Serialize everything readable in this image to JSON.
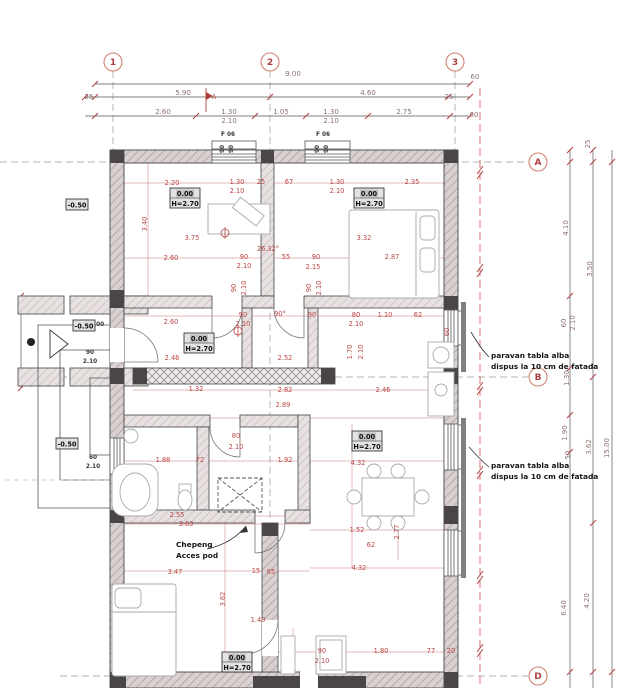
{
  "drawing": {
    "colors": {
      "dim_red": "#b84444",
      "chain_gray": "#8f7070",
      "axis_red": "#cc5555",
      "axis_gray": "#9a9a9a",
      "wall_fill": "#d8d0d0",
      "column_dark": "#4a4549",
      "bubble": "#d08070",
      "ink": "#444444"
    },
    "grid": {
      "col_bubble_y": 62,
      "row_bubble_x": 538,
      "cols": [
        {
          "label": "1",
          "x": 113
        },
        {
          "label": "2",
          "x": 270
        },
        {
          "label": "3",
          "x": 455
        }
      ],
      "rows": [
        {
          "label": "A",
          "y": 162
        },
        {
          "label": "B",
          "y": 377
        },
        {
          "label": "D",
          "y": 676
        }
      ]
    },
    "level_boxes": [
      {
        "l1": "0.00",
        "l2": "H=2.70",
        "x": 170,
        "y": 188
      },
      {
        "l1": "0.00",
        "l2": "H=2.70",
        "x": 354,
        "y": 188
      },
      {
        "l1": "0.00",
        "l2": "H=2.70",
        "x": 184,
        "y": 333
      },
      {
        "l1": "0.00",
        "l2": "H=2.70",
        "x": 352,
        "y": 431
      },
      {
        "l1": "0.00",
        "l2": "H=2.70",
        "x": 222,
        "y": 652
      }
    ],
    "elev_boxes": [
      {
        "t": "-0.50",
        "x": 66,
        "y": 199
      },
      {
        "t": "-0.50",
        "x": 73,
        "y": 320
      },
      {
        "t": "-0.50",
        "x": 56,
        "y": 438
      }
    ],
    "notes": [
      {
        "lines": [
          "paravan tabla alba",
          "dispus la 10 cm de fatada"
        ],
        "x": 491,
        "y": 358
      },
      {
        "lines": [
          "paravan tabla alba",
          "dispus la 10 cm de fatada"
        ],
        "x": 491,
        "y": 468
      },
      {
        "lines": [
          "Chepeng",
          "Acces pod"
        ],
        "x": 176,
        "y": 547
      }
    ],
    "labels": [
      {
        "t": "9.00",
        "x": 293,
        "y": 76,
        "c": "g"
      },
      {
        "t": "60",
        "x": 475,
        "y": 79,
        "c": "g"
      },
      {
        "t": "25",
        "x": 89,
        "y": 99,
        "c": "g"
      },
      {
        "t": "5.90",
        "x": 183,
        "y": 95,
        "c": "g"
      },
      {
        "t": "4.60",
        "x": 368,
        "y": 95,
        "c": "g"
      },
      {
        "t": "25",
        "x": 449,
        "y": 99,
        "c": "g"
      },
      {
        "t": "2.60",
        "x": 163,
        "y": 114,
        "c": "g"
      },
      {
        "t": "1.30",
        "x": 229,
        "y": 114,
        "c": "g"
      },
      {
        "t": "2.10",
        "x": 229,
        "y": 123,
        "c": "g"
      },
      {
        "t": "1.05",
        "x": 281,
        "y": 114,
        "c": "g"
      },
      {
        "t": "1.30",
        "x": 331,
        "y": 114,
        "c": "g"
      },
      {
        "t": "2.10",
        "x": 331,
        "y": 123,
        "c": "g"
      },
      {
        "t": "2.75",
        "x": 404,
        "y": 114,
        "c": "g"
      },
      {
        "t": "60",
        "x": 474,
        "y": 117,
        "c": "g"
      },
      {
        "t": "A",
        "x": 214,
        "y": 99
      },
      {
        "t": "F 06",
        "x": 228,
        "y": 136,
        "c": "t"
      },
      {
        "t": "F 06",
        "x": 323,
        "y": 136,
        "c": "t"
      },
      {
        "t": "90",
        "x": 224,
        "y": 149,
        "c": "t",
        "r": 1
      },
      {
        "t": "90",
        "x": 233,
        "y": 149,
        "c": "t",
        "r": 1
      },
      {
        "t": "90",
        "x": 319,
        "y": 149,
        "c": "t",
        "r": 1
      },
      {
        "t": "90",
        "x": 328,
        "y": 149,
        "c": "t",
        "r": 1
      },
      {
        "t": "2.20",
        "x": 172,
        "y": 185
      },
      {
        "t": "1.30",
        "x": 237,
        "y": 184
      },
      {
        "t": "2.10",
        "x": 237,
        "y": 193
      },
      {
        "t": "25",
        "x": 261,
        "y": 184
      },
      {
        "t": "67",
        "x": 289,
        "y": 184
      },
      {
        "t": "1.30",
        "x": 337,
        "y": 184
      },
      {
        "t": "2.10",
        "x": 337,
        "y": 193
      },
      {
        "t": "2.35",
        "x": 412,
        "y": 184
      },
      {
        "t": "3.40",
        "x": 147,
        "y": 224,
        "r": 1
      },
      {
        "t": "3.75",
        "x": 192,
        "y": 240
      },
      {
        "t": "3.32",
        "x": 364,
        "y": 240
      },
      {
        "t": "2.60",
        "x": 171,
        "y": 260
      },
      {
        "t": "90",
        "x": 244,
        "y": 259
      },
      {
        "t": "2.10",
        "x": 244,
        "y": 268
      },
      {
        "t": "55",
        "x": 286,
        "y": 259
      },
      {
        "t": "90",
        "x": 316,
        "y": 259
      },
      {
        "t": "2.87",
        "x": 392,
        "y": 259
      },
      {
        "t": "2.15",
        "x": 313,
        "y": 269
      },
      {
        "t": "26.32°",
        "x": 268,
        "y": 251
      },
      {
        "t": "90",
        "x": 236,
        "y": 288,
        "r": 1
      },
      {
        "t": "2.10",
        "x": 246,
        "y": 288,
        "r": 1
      },
      {
        "t": "90",
        "x": 311,
        "y": 288,
        "r": 1
      },
      {
        "t": "2.10",
        "x": 321,
        "y": 288,
        "r": 1
      },
      {
        "t": "2.60",
        "x": 171,
        "y": 324
      },
      {
        "t": "90",
        "x": 243,
        "y": 317
      },
      {
        "t": "2.10",
        "x": 243,
        "y": 326
      },
      {
        "t": "90°",
        "x": 280,
        "y": 316
      },
      {
        "t": "90",
        "x": 312,
        "y": 317
      },
      {
        "t": "80",
        "x": 356,
        "y": 317
      },
      {
        "t": "2.10",
        "x": 356,
        "y": 326
      },
      {
        "t": "1.10",
        "x": 385,
        "y": 317
      },
      {
        "t": "62",
        "x": 418,
        "y": 317
      },
      {
        "t": "2.46",
        "x": 172,
        "y": 360
      },
      {
        "t": "2.52",
        "x": 285,
        "y": 360
      },
      {
        "t": "1.70",
        "x": 352,
        "y": 352,
        "r": 1
      },
      {
        "t": "2.10",
        "x": 363,
        "y": 352,
        "r": 1
      },
      {
        "t": "1.32",
        "x": 196,
        "y": 391
      },
      {
        "t": "2.82",
        "x": 285,
        "y": 392
      },
      {
        "t": "2.46",
        "x": 383,
        "y": 392
      },
      {
        "t": "2.89",
        "x": 283,
        "y": 407
      },
      {
        "t": "80",
        "x": 236,
        "y": 438
      },
      {
        "t": "2.10",
        "x": 236,
        "y": 449
      },
      {
        "t": "1.88",
        "x": 163,
        "y": 462
      },
      {
        "t": "72",
        "x": 200,
        "y": 462
      },
      {
        "t": "1.92",
        "x": 285,
        "y": 462
      },
      {
        "t": "2.55",
        "x": 177,
        "y": 517
      },
      {
        "t": "3.63",
        "x": 186,
        "y": 526
      },
      {
        "t": "3.47",
        "x": 175,
        "y": 574
      },
      {
        "t": "15",
        "x": 256,
        "y": 573
      },
      {
        "t": "85",
        "x": 271,
        "y": 574
      },
      {
        "t": "3.62",
        "x": 225,
        "y": 599,
        "r": 1
      },
      {
        "t": "1.40",
        "x": 258,
        "y": 622
      },
      {
        "t": "90",
        "x": 322,
        "y": 653
      },
      {
        "t": "2.10",
        "x": 322,
        "y": 663
      },
      {
        "t": "1.80",
        "x": 381,
        "y": 653
      },
      {
        "t": "77",
        "x": 431,
        "y": 653
      },
      {
        "t": "20",
        "x": 451,
        "y": 653
      },
      {
        "t": "4.32",
        "x": 358,
        "y": 465
      },
      {
        "t": "1.52",
        "x": 357,
        "y": 532
      },
      {
        "t": "62",
        "x": 371,
        "y": 547
      },
      {
        "t": "2.77",
        "x": 399,
        "y": 532,
        "r": 1
      },
      {
        "t": "4.32",
        "x": 359,
        "y": 570
      },
      {
        "t": "60",
        "x": 449,
        "y": 332,
        "r": 1
      },
      {
        "t": "1.00",
        "x": 97,
        "y": 326,
        "c": "t"
      },
      {
        "t": "90",
        "x": 90,
        "y": 354,
        "c": "t"
      },
      {
        "t": "2.10",
        "x": 90,
        "y": 363,
        "c": "t"
      },
      {
        "t": "60",
        "x": 93,
        "y": 459,
        "c": "t"
      },
      {
        "t": "2.10",
        "x": 93,
        "y": 468,
        "c": "t"
      },
      {
        "t": "25",
        "x": 590,
        "y": 144,
        "c": "g",
        "r": 1
      },
      {
        "t": "4.10",
        "x": 568,
        "y": 228,
        "c": "g",
        "r": 1
      },
      {
        "t": "3.50",
        "x": 592,
        "y": 269,
        "c": "g",
        "r": 1
      },
      {
        "t": "60",
        "x": 566,
        "y": 323,
        "c": "g",
        "r": 1
      },
      {
        "t": "2.10",
        "x": 575,
        "y": 323,
        "c": "g",
        "r": 1
      },
      {
        "t": "1.30",
        "x": 569,
        "y": 378,
        "c": "g",
        "r": 1
      },
      {
        "t": "1.90",
        "x": 567,
        "y": 433,
        "c": "g",
        "r": 1
      },
      {
        "t": "50",
        "x": 570,
        "y": 455,
        "c": "g",
        "r": 1
      },
      {
        "t": "3.62",
        "x": 591,
        "y": 447,
        "c": "g",
        "r": 1
      },
      {
        "t": "15.00",
        "x": 609,
        "y": 448,
        "c": "g",
        "r": 1
      },
      {
        "t": "6.40",
        "x": 566,
        "y": 608,
        "c": "g",
        "r": 1
      },
      {
        "t": "4.20",
        "x": 589,
        "y": 601,
        "c": "g",
        "r": 1
      }
    ]
  }
}
